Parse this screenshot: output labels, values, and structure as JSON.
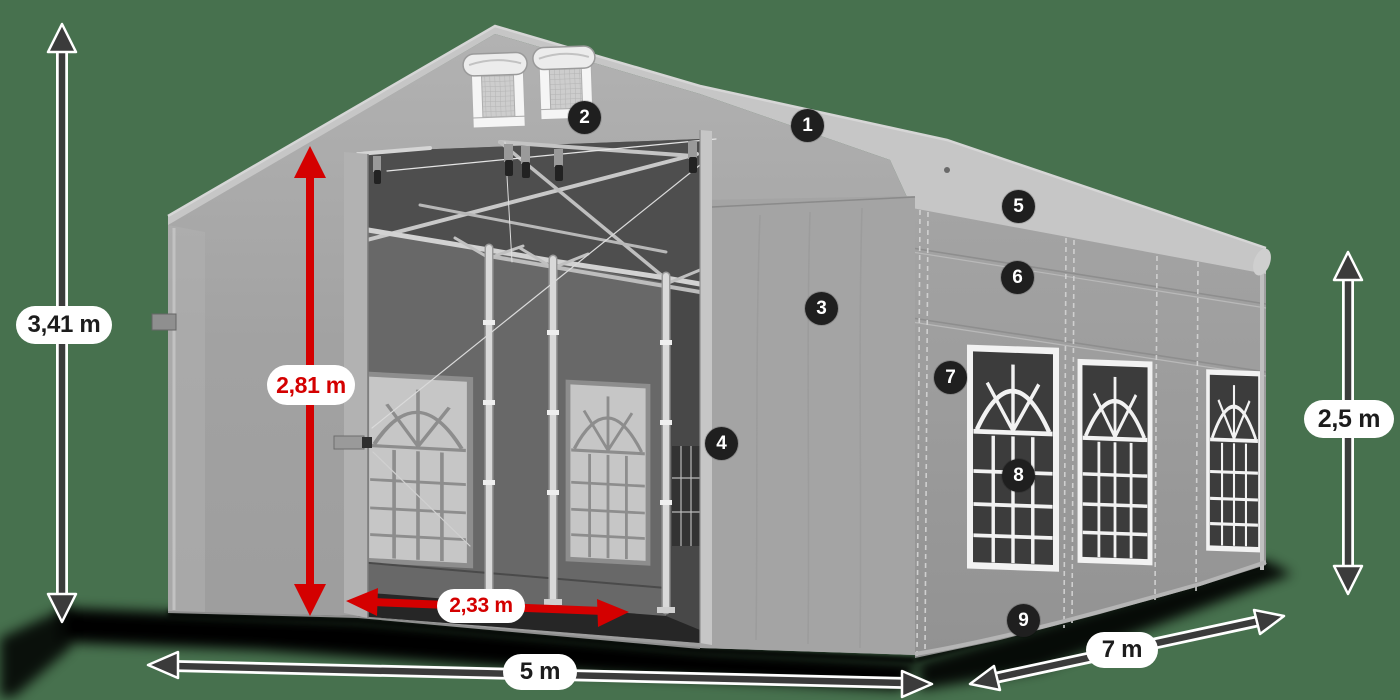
{
  "colors": {
    "background": "#47714E",
    "accent_red": "#D40000",
    "dark_arrow": "#3B3B3B",
    "callout_background": "#1F1F1F",
    "tent_gray": "#9C9C9C"
  },
  "dimensions": {
    "total_height": "3,41 m",
    "entrance_height": "2,81 m",
    "entrance_width": "2,33 m",
    "front_width": "5 m",
    "side_length": "7 m",
    "side_height": "2,5 m"
  },
  "callouts": [
    {
      "number": "1"
    },
    {
      "number": "2"
    },
    {
      "number": "3"
    },
    {
      "number": "4"
    },
    {
      "number": "5"
    },
    {
      "number": "6"
    },
    {
      "number": "7"
    },
    {
      "number": "8"
    },
    {
      "number": "9"
    }
  ]
}
